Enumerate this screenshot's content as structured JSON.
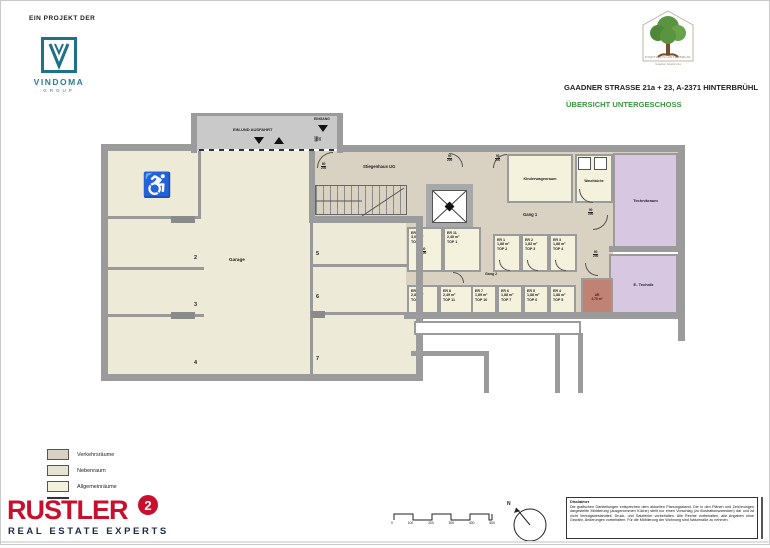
{
  "header": {
    "project_label": "EIN PROJEKT DER",
    "vindoma": {
      "name": "VINDOMA",
      "sub": "GROUP"
    },
    "estate_logo": {
      "line1": "STADTHAUS HINTERBRÜHL",
      "line2": "Gaadner Straße 21a"
    },
    "address": "GAADNER STRASSE 21a + 23, A-2371 HINTERBRÜHL",
    "title": "ÜBERSICHT UNTERGESCHOSS"
  },
  "plan": {
    "ramp_label": "EIN-UND AUSFAHRT",
    "entrance_label": "EINGANG",
    "rooms": {
      "garage": "Garage",
      "stiegenhaus": "Stiegenhaus UG",
      "gang1": "Gang 1",
      "gang2": "Gang 2",
      "kinderwagen": "Kinderwagenraum",
      "waschkueche": "Waschküche",
      "technik": "Technikraum",
      "etechnik": "E- Technik",
      "ar_name": "AR",
      "ar_area": "2,78 m²"
    },
    "parking": [
      "2",
      "3",
      "4",
      "5",
      "6",
      "7"
    ],
    "storage_top": [
      {
        "id": "ER 10",
        "area": "3,05 m²",
        "top": "TOP 9"
      },
      {
        "id": "ER 11",
        "area": "2,48 m²",
        "top": "TOP 1"
      },
      {
        "id": "ER 1",
        "area": "1,88 m²",
        "top": "TOP 2"
      },
      {
        "id": "ER 2",
        "area": "1,83 m²",
        "top": "TOP 3"
      },
      {
        "id": "ER 3",
        "area": "1,88 m²",
        "top": "TOP 4"
      }
    ],
    "storage_bottom": [
      {
        "id": "ER 9",
        "area": "2,84 m²",
        "top": "TOP 8"
      },
      {
        "id": "ER 8",
        "area": "2,49 m²",
        "top": "TOP 11"
      },
      {
        "id": "ER 7",
        "area": "1,89 m²",
        "top": "TOP 10"
      },
      {
        "id": "ER 6",
        "area": "1,88 m²",
        "top": "TOP 7"
      },
      {
        "id": "ER 5",
        "area": "1,88 m²",
        "top": "TOP 6"
      },
      {
        "id": "ER 4",
        "area": "1,88 m²",
        "top": "TOP 5"
      }
    ],
    "door_labels": {
      "d90": {
        "top": "90",
        "bottom": "200"
      },
      "d80": {
        "top": "80",
        "bottom": "200"
      }
    }
  },
  "legend": {
    "items": [
      {
        "label": "Verkehrsräume",
        "color": "#d9d1c2"
      },
      {
        "label": "Nebenraum",
        "color": "#e6e3d0"
      },
      {
        "label": "Allgemeinräume",
        "color": "#f4f1dc"
      }
    ]
  },
  "footer": {
    "brand": "RUSTLER",
    "brand_sup": "2",
    "tagline": "REAL ESTATE EXPERTS",
    "scale_ticks": [
      "0",
      "100",
      "200",
      "300",
      "400",
      "500"
    ],
    "north_label": "N",
    "disclaimer_title": "Disclaimer",
    "disclaimer_text": "Die grafischen Darstellungen entsprechen dem aktuellen Planungsstand. Die in den Plänen und Zeichnungen dargestellte Möblierung (ausgenommen Küche) stellt nur einen Vorschlag (zu Illustrationszwecken) dar und ist nicht Vertragsbestandteil. Druck- und Satzfehler vorbehalten. Alle Rechte vorbehalten, alle Angaben ohne Gewähr, Änderungen vorbehalten. Für die Möblierung der Wohnung sind Naturmaße zu nehmen."
  },
  "colors": {
    "vindoma_teal": "#1f7089",
    "title_green": "#3a9642",
    "rustler_red": "#c8102e",
    "navy": "#1c2b45",
    "wall_gray": "#9b9b9b",
    "technik_purple": "#d8c7e0",
    "ar_brick": "#c08272"
  }
}
